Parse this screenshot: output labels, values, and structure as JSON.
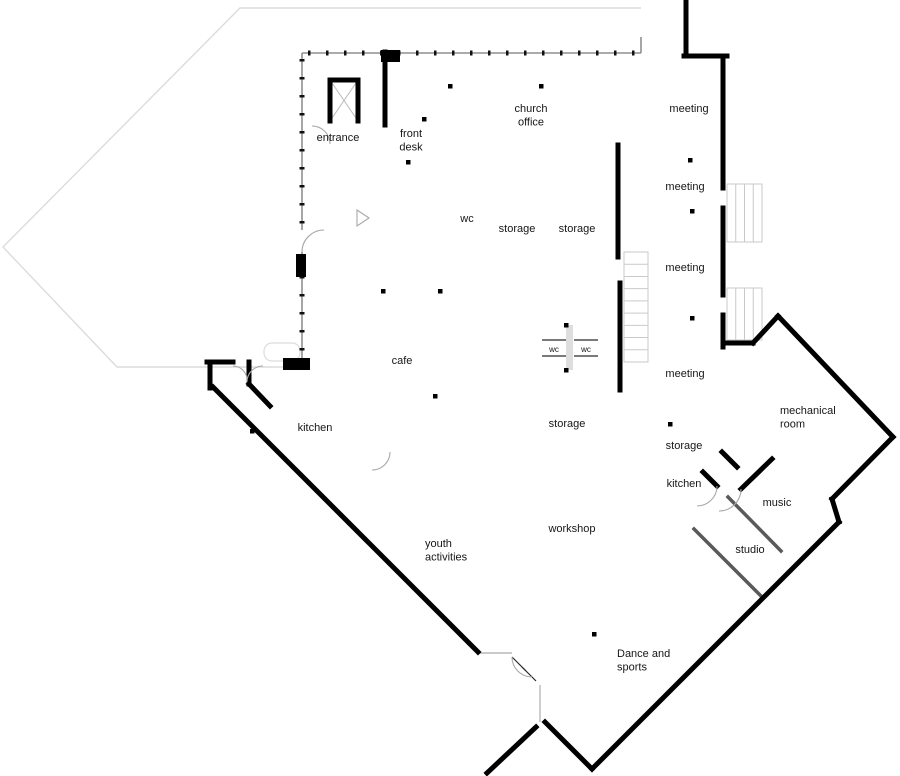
{
  "meta": {
    "type": "architectural-floor-plan",
    "background": "#ffffff"
  },
  "palette": {
    "exterior_wall": "#000000",
    "interior_wall": "#1c1c1c",
    "gray_partition": "#5a5a5a",
    "thin_dark": "#2a2a2a",
    "thin_gray": "#b9b9b9",
    "envelope": "#8f8f8f",
    "faint": "#dcdcdc",
    "arc_gray": "#a8a8a8",
    "light_fill": "#dedede"
  },
  "labels": [
    {
      "id": "entrance",
      "lines": [
        "entrance"
      ],
      "x": 338,
      "y": 141,
      "anchor": "middle",
      "size": 11
    },
    {
      "id": "front-desk",
      "lines": [
        "front",
        "desk"
      ],
      "x": 411,
      "y": 137,
      "anchor": "middle",
      "size": 11
    },
    {
      "id": "church-office",
      "lines": [
        "church",
        "office"
      ],
      "x": 531,
      "y": 112,
      "anchor": "middle",
      "size": 11
    },
    {
      "id": "meeting-1",
      "lines": [
        "meeting"
      ],
      "x": 689,
      "y": 112,
      "anchor": "middle",
      "size": 11
    },
    {
      "id": "meeting-2",
      "lines": [
        "meeting"
      ],
      "x": 685,
      "y": 190,
      "anchor": "middle",
      "size": 11
    },
    {
      "id": "meeting-3",
      "lines": [
        "meeting"
      ],
      "x": 685,
      "y": 271,
      "anchor": "middle",
      "size": 11
    },
    {
      "id": "meeting-4",
      "lines": [
        "meeting"
      ],
      "x": 685,
      "y": 377,
      "anchor": "middle",
      "size": 11
    },
    {
      "id": "wc-top",
      "lines": [
        "wc"
      ],
      "x": 467,
      "y": 222,
      "anchor": "middle",
      "size": 11
    },
    {
      "id": "storage-1",
      "lines": [
        "storage"
      ],
      "x": 517,
      "y": 232,
      "anchor": "middle",
      "size": 11
    },
    {
      "id": "storage-2",
      "lines": [
        "storage"
      ],
      "x": 577,
      "y": 232,
      "anchor": "middle",
      "size": 11
    },
    {
      "id": "cafe",
      "lines": [
        "cafe"
      ],
      "x": 402,
      "y": 364,
      "anchor": "middle",
      "size": 11
    },
    {
      "id": "wc-left",
      "lines": [
        "wc"
      ],
      "x": 554,
      "y": 352,
      "anchor": "middle",
      "size": 8
    },
    {
      "id": "wc-right",
      "lines": [
        "wc"
      ],
      "x": 586,
      "y": 352,
      "anchor": "middle",
      "size": 8
    },
    {
      "id": "storage-mid",
      "lines": [
        "storage"
      ],
      "x": 567,
      "y": 427,
      "anchor": "middle",
      "size": 11
    },
    {
      "id": "storage-right",
      "lines": [
        "storage"
      ],
      "x": 684,
      "y": 449,
      "anchor": "middle",
      "size": 11
    },
    {
      "id": "kitchen-right",
      "lines": [
        "kitchen"
      ],
      "x": 684,
      "y": 487,
      "anchor": "middle",
      "size": 11
    },
    {
      "id": "kitchen-left",
      "lines": [
        "kitchen"
      ],
      "x": 315,
      "y": 431,
      "anchor": "middle",
      "size": 11
    },
    {
      "id": "mechanical-room",
      "lines": [
        "mechanical",
        "room"
      ],
      "x": 780,
      "y": 414,
      "anchor": "start",
      "size": 11
    },
    {
      "id": "music",
      "lines": [
        "music"
      ],
      "x": 777,
      "y": 506,
      "anchor": "middle",
      "size": 11
    },
    {
      "id": "studio",
      "lines": [
        "studio"
      ],
      "x": 750,
      "y": 553,
      "anchor": "middle",
      "size": 11
    },
    {
      "id": "youth-activities",
      "lines": [
        "youth",
        "activities"
      ],
      "x": 425,
      "y": 547,
      "anchor": "start",
      "size": 11
    },
    {
      "id": "workshop",
      "lines": [
        "workshop"
      ],
      "x": 572,
      "y": 532,
      "anchor": "middle",
      "size": 11
    },
    {
      "id": "dance-and-sports",
      "lines": [
        "Dance and",
        "sports"
      ],
      "x": 617,
      "y": 657,
      "anchor": "start",
      "size": 11
    }
  ],
  "walls": {
    "exterior_thick": [
      [
        686,
        2,
        686,
        56
      ],
      [
        684,
        56,
        727,
        56
      ],
      [
        723,
        56,
        723,
        188
      ],
      [
        723,
        208,
        723,
        295
      ],
      [
        723,
        315,
        723,
        347
      ],
      [
        723,
        343,
        753,
        343
      ],
      [
        753,
        343,
        778,
        316
      ],
      [
        778,
        316,
        893,
        437
      ],
      [
        893,
        437,
        832,
        499
      ],
      [
        832,
        499,
        839,
        522
      ],
      [
        839,
        522,
        592,
        769
      ],
      [
        592,
        769,
        545,
        722
      ],
      [
        536,
        727,
        487,
        773
      ],
      [
        772,
        459,
        741,
        489
      ],
      [
        213,
        387,
        478,
        652
      ],
      [
        207,
        362,
        233,
        362
      ],
      [
        210,
        362,
        210,
        388
      ],
      [
        249,
        362,
        249,
        384
      ],
      [
        249,
        384,
        270,
        406
      ],
      [
        330,
        121,
        330,
        80
      ],
      [
        330,
        80,
        358,
        80
      ],
      [
        358,
        80,
        358,
        121
      ],
      [
        385,
        52,
        385,
        125
      ],
      [
        618,
        145,
        618,
        257
      ],
      [
        620,
        283,
        620,
        390
      ],
      [
        722,
        452,
        737,
        467
      ],
      [
        703,
        472,
        717,
        486
      ]
    ],
    "interior": [
      [
        647,
        57,
        647,
        118
      ],
      [
        647,
        138,
        647,
        213
      ],
      [
        647,
        233,
        647,
        262
      ],
      [
        647,
        282,
        647,
        340
      ],
      [
        647,
        360,
        647,
        424
      ],
      [
        647,
        160,
        722,
        160
      ],
      [
        647,
        211,
        722,
        211
      ],
      [
        647,
        318,
        722,
        318
      ],
      [
        647,
        424,
        718,
        424
      ],
      [
        647,
        463,
        718,
        463
      ],
      [
        647,
        424,
        647,
        505
      ],
      [
        718,
        424,
        718,
        468
      ],
      [
        722,
        347,
        722,
        452
      ],
      [
        668,
        527,
        700,
        496
      ],
      [
        540,
        683,
        585,
        641
      ],
      [
        601,
        626,
        694,
        529
      ],
      [
        320,
        384,
        390,
        452
      ],
      [
        355,
        457,
        367,
        469
      ],
      [
        373,
        463,
        385,
        475
      ],
      [
        404,
        469,
        417,
        482
      ],
      [
        437,
        475,
        618,
        475
      ],
      [
        513,
        468,
        513,
        483
      ],
      [
        563,
        470,
        563,
        483
      ],
      [
        513,
        513,
        513,
        572
      ],
      [
        513,
        572,
        612,
        572
      ],
      [
        518,
        572,
        518,
        582
      ],
      [
        603,
        572,
        603,
        582
      ],
      [
        618,
        512,
        618,
        540
      ],
      [
        607,
        512,
        618,
        512
      ],
      [
        513,
        598,
        513,
        620
      ],
      [
        513,
        610,
        553,
        610
      ],
      [
        533,
        610,
        533,
        620
      ],
      [
        455,
        289,
        517,
        289
      ],
      [
        514,
        285,
        514,
        370
      ],
      [
        542,
        290,
        542,
        323
      ],
      [
        590,
        290,
        590,
        323
      ],
      [
        542,
        323,
        598,
        323
      ],
      [
        583,
        288,
        598,
        288
      ],
      [
        492,
        370,
        620,
        370
      ],
      [
        514,
        370,
        514,
        386
      ],
      [
        514,
        386,
        536,
        386
      ],
      [
        302,
        126,
        312,
        126
      ],
      [
        330,
        126,
        383,
        126
      ],
      [
        378,
        125,
        378,
        156
      ],
      [
        377,
        156,
        402,
        156
      ],
      [
        425,
        55,
        425,
        115
      ],
      [
        461,
        55,
        461,
        117
      ],
      [
        461,
        140,
        461,
        178
      ],
      [
        420,
        178,
        461,
        178
      ],
      [
        432,
        196,
        545,
        196
      ],
      [
        432,
        196,
        432,
        237
      ],
      [
        427,
        237,
        490,
        237
      ],
      [
        490,
        196,
        490,
        257
      ],
      [
        545,
        195,
        545,
        257
      ],
      [
        427,
        255,
        618,
        255
      ],
      [
        395,
        196,
        452,
        260
      ],
      [
        383,
        196,
        397,
        196
      ],
      [
        537,
        147,
        618,
        147
      ],
      [
        538,
        147,
        538,
        195
      ],
      [
        565,
        147,
        565,
        195
      ],
      [
        592,
        147,
        592,
        195
      ],
      [
        615,
        147,
        615,
        195
      ],
      [
        538,
        172,
        615,
        172
      ],
      [
        538,
        195,
        618,
        195
      ],
      [
        540,
        55,
        540,
        83
      ],
      [
        513,
        415,
        513,
        485
      ],
      [
        618,
        413,
        618,
        487
      ]
    ],
    "gray_partitions": [
      [
        728,
        497,
        781,
        551
      ],
      [
        694,
        529,
        763,
        598
      ]
    ],
    "thin_dark": [
      [
        542,
        340,
        566,
        340
      ],
      [
        542,
        356,
        566,
        356
      ],
      [
        574,
        340,
        598,
        340
      ],
      [
        574,
        356,
        598,
        356
      ],
      [
        512,
        657,
        526,
        671
      ],
      [
        522,
        667,
        536,
        681
      ]
    ],
    "thin_gray": [
      [
        540,
        685,
        540,
        722
      ],
      [
        478,
        653,
        512,
        653
      ]
    ],
    "envelope": [
      [
        302,
        53,
        641,
        53
      ],
      [
        302,
        53,
        302,
        230
      ],
      [
        302,
        252,
        302,
        360
      ],
      [
        641,
        37,
        641,
        53
      ]
    ],
    "mullion_dashes": [
      [
        308,
        53,
        638,
        53
      ],
      [
        302,
        59,
        302,
        226
      ],
      [
        302,
        258,
        302,
        354
      ]
    ],
    "elevator_x": [
      [
        330,
        80,
        358,
        121
      ],
      [
        358,
        80,
        330,
        121
      ]
    ],
    "faint_outline": [
      [
        641,
        8
      ],
      [
        240,
        8
      ],
      [
        3,
        247
      ],
      [
        117,
        367
      ],
      [
        284,
        367
      ]
    ]
  },
  "paths": {
    "dark_curves": [
      "M647,505 Q647,528 670,528",
      "M618,540 Q618,562 600,567",
      "M513,620 Q557,616 590,594"
    ],
    "door_arcs": [
      "M312,126 A18,18 0 0 1 330,144",
      "M302,252 A22,22 0 0 1 324,230",
      "M233,366 A14,14 0 0 1 247,380",
      "M263,366 A16,16 0 0 0 247,382",
      "M741,489 A22,22 0 0 1 719,511",
      "M717,486 A20,20 0 0 1 697,506",
      "M390,452 A18,18 0 0 1 372,470",
      "M512,657 A20,20 0 0 0 532,677",
      "M357,210 L369,218 L357,226 Z"
    ]
  },
  "rects": {
    "solid_black": [
      [
        381,
        50,
        19,
        12
      ],
      [
        283,
        358,
        27,
        12
      ],
      [
        296,
        254,
        10,
        23
      ]
    ],
    "light_fills": [
      [
        566,
        325,
        7,
        45
      ]
    ],
    "canopy": {
      "x": 264,
      "y": 343,
      "w": 36,
      "h": 18,
      "r": 8
    }
  },
  "stairs": {
    "corridor": {
      "x": 624,
      "y": 252,
      "w": 24,
      "h": 110,
      "treads": 8,
      "dir": "horizontal"
    },
    "porches": [
      {
        "x": 727,
        "y": 184,
        "w": 35,
        "h": 58,
        "treads": 3,
        "dir": "vertical"
      },
      {
        "x": 727,
        "y": 288,
        "w": 35,
        "h": 52,
        "treads": 3,
        "dir": "vertical"
      }
    ]
  },
  "door_dots": [
    [
      450,
      86
    ],
    [
      541,
      86
    ],
    [
      408,
      162
    ],
    [
      424,
      119
    ],
    [
      690,
      160
    ],
    [
      692,
      211
    ],
    [
      692,
      318
    ],
    [
      670,
      424
    ],
    [
      383,
      291
    ],
    [
      440,
      291
    ],
    [
      566,
      325
    ],
    [
      566,
      370
    ],
    [
      435,
      396
    ],
    [
      594,
      634
    ],
    [
      252,
      431
    ]
  ]
}
